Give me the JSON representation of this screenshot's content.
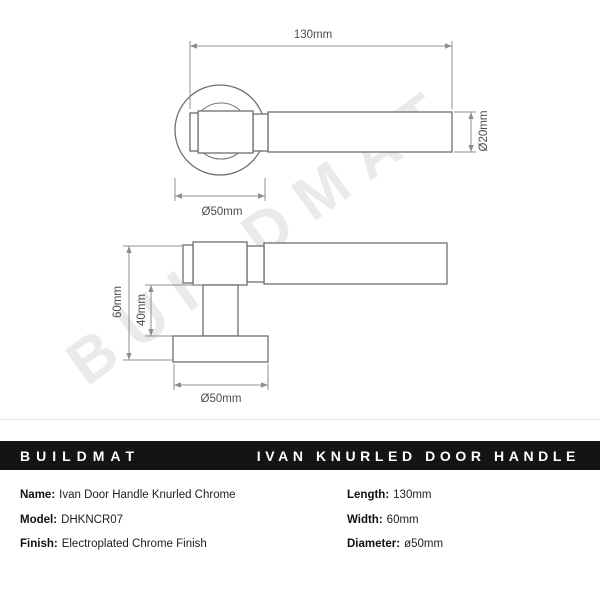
{
  "watermark": "BUILDMAT",
  "drawings": {
    "top_view": {
      "length_label": "130mm",
      "rose_diameter_label": "Ø50mm",
      "bar_diameter_label": "Ø20mm"
    },
    "side_view": {
      "height_label": "60mm",
      "stem_height_label": "40mm",
      "rose_diameter_label": "Ø50mm"
    }
  },
  "banner": {
    "brand": "BUILDMAT",
    "product": "IVAN KNURLED DOOR HANDLE"
  },
  "specs": {
    "left": [
      {
        "label": "Name:",
        "value": "Ivan Door Handle Knurled Chrome"
      },
      {
        "label": "Model:",
        "value": "DHKNCR07"
      },
      {
        "label": "Finish:",
        "value": "Electroplated Chrome Finish"
      }
    ],
    "right": [
      {
        "label": "Length:",
        "value": "130mm"
      },
      {
        "label": "Width:",
        "value": "60mm"
      },
      {
        "label": "Diameter:",
        "value": "ø50mm"
      }
    ]
  },
  "colors": {
    "banner_bg": "#141414",
    "banner_text": "#ffffff",
    "line": "#6e6e6e",
    "dimension": "#8f8f8f",
    "watermark": "#eaeaea"
  }
}
